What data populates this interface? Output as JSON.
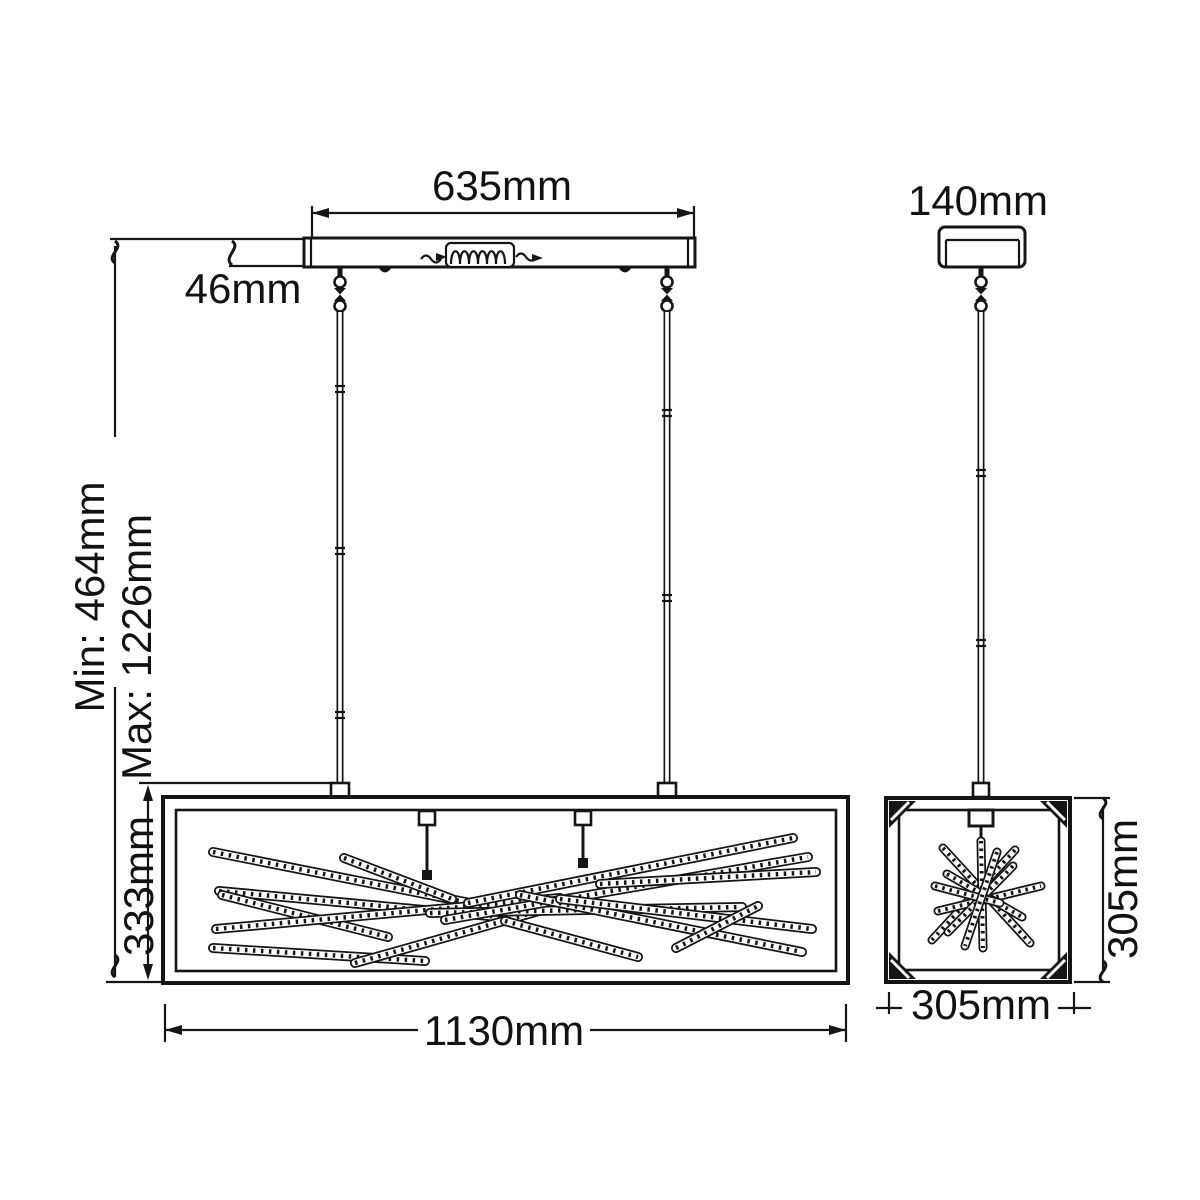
{
  "colors": {
    "background": "#ffffff",
    "line": "#151515",
    "text": "#121212"
  },
  "views": {
    "front": {
      "name": "front-elevation",
      "dims": {
        "canopy_width": "635mm",
        "canopy_height": "46mm",
        "min_drop": "Min: 464mm",
        "max_drop": "Max: 1226mm",
        "body_height": "333mm",
        "body_width": "1130mm"
      }
    },
    "side": {
      "name": "side-elevation",
      "dims": {
        "canopy_width": "140mm",
        "body_height": "305mm",
        "body_width": "305mm"
      }
    }
  }
}
